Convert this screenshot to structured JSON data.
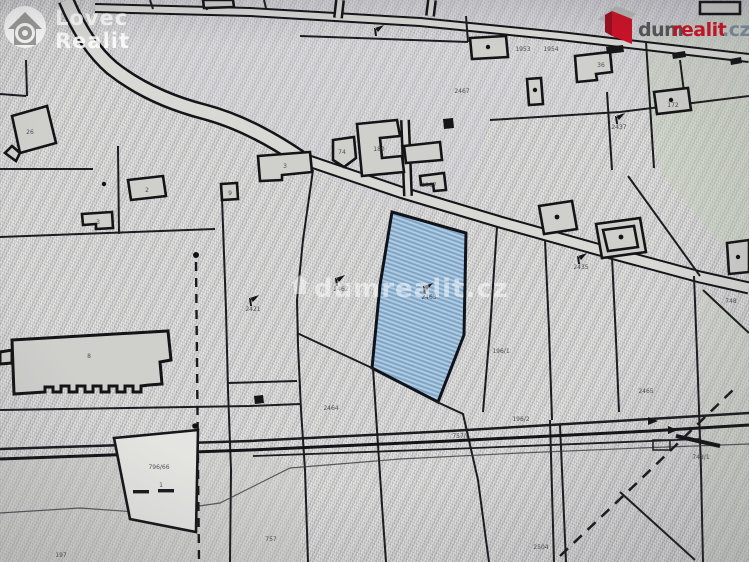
{
  "branding": {
    "lovec_realit": {
      "line1": "Lovec",
      "line2": "Realit"
    },
    "dumrealit_logo": {
      "prefix": "dum",
      "accent": "realit",
      "tld": ".cz"
    },
    "center_watermark": "dumrealit.cz"
  },
  "colors": {
    "highlighted_parcel": "#8db3d3",
    "logo_red": "#cf1126",
    "logo_gray": "#55555a",
    "logo_tld_gray": "#7d8fa0",
    "map_lines": "#17171b",
    "paper": "#d6d6d3",
    "watermark_white": "rgba(255,255,255,0.5)"
  },
  "map": {
    "type": "cadastral-plan",
    "highlighted_parcel_label": "2463",
    "labels": [
      {
        "t": "26"
      },
      {
        "t": "2"
      },
      {
        "t": "3"
      },
      {
        "t": "9"
      },
      {
        "t": "3"
      },
      {
        "t": "74"
      },
      {
        "t": "180"
      },
      {
        "t": "1907"
      },
      {
        "t": "1953"
      },
      {
        "t": "1954"
      },
      {
        "t": "36"
      },
      {
        "t": "172"
      },
      {
        "t": "2467"
      },
      {
        "t": "2437"
      },
      {
        "t": "2435"
      },
      {
        "t": "2463"
      },
      {
        "t": "2462"
      },
      {
        "t": "2421"
      },
      {
        "t": "2464"
      },
      {
        "t": "757"
      },
      {
        "t": "796/66"
      },
      {
        "t": "1"
      },
      {
        "t": "197"
      },
      {
        "t": "196/2"
      },
      {
        "t": "757/6"
      },
      {
        "t": "2504"
      },
      {
        "t": "748/1"
      },
      {
        "t": "2465"
      },
      {
        "t": "748"
      },
      {
        "t": "196/1"
      },
      {
        "t": "8"
      }
    ]
  }
}
